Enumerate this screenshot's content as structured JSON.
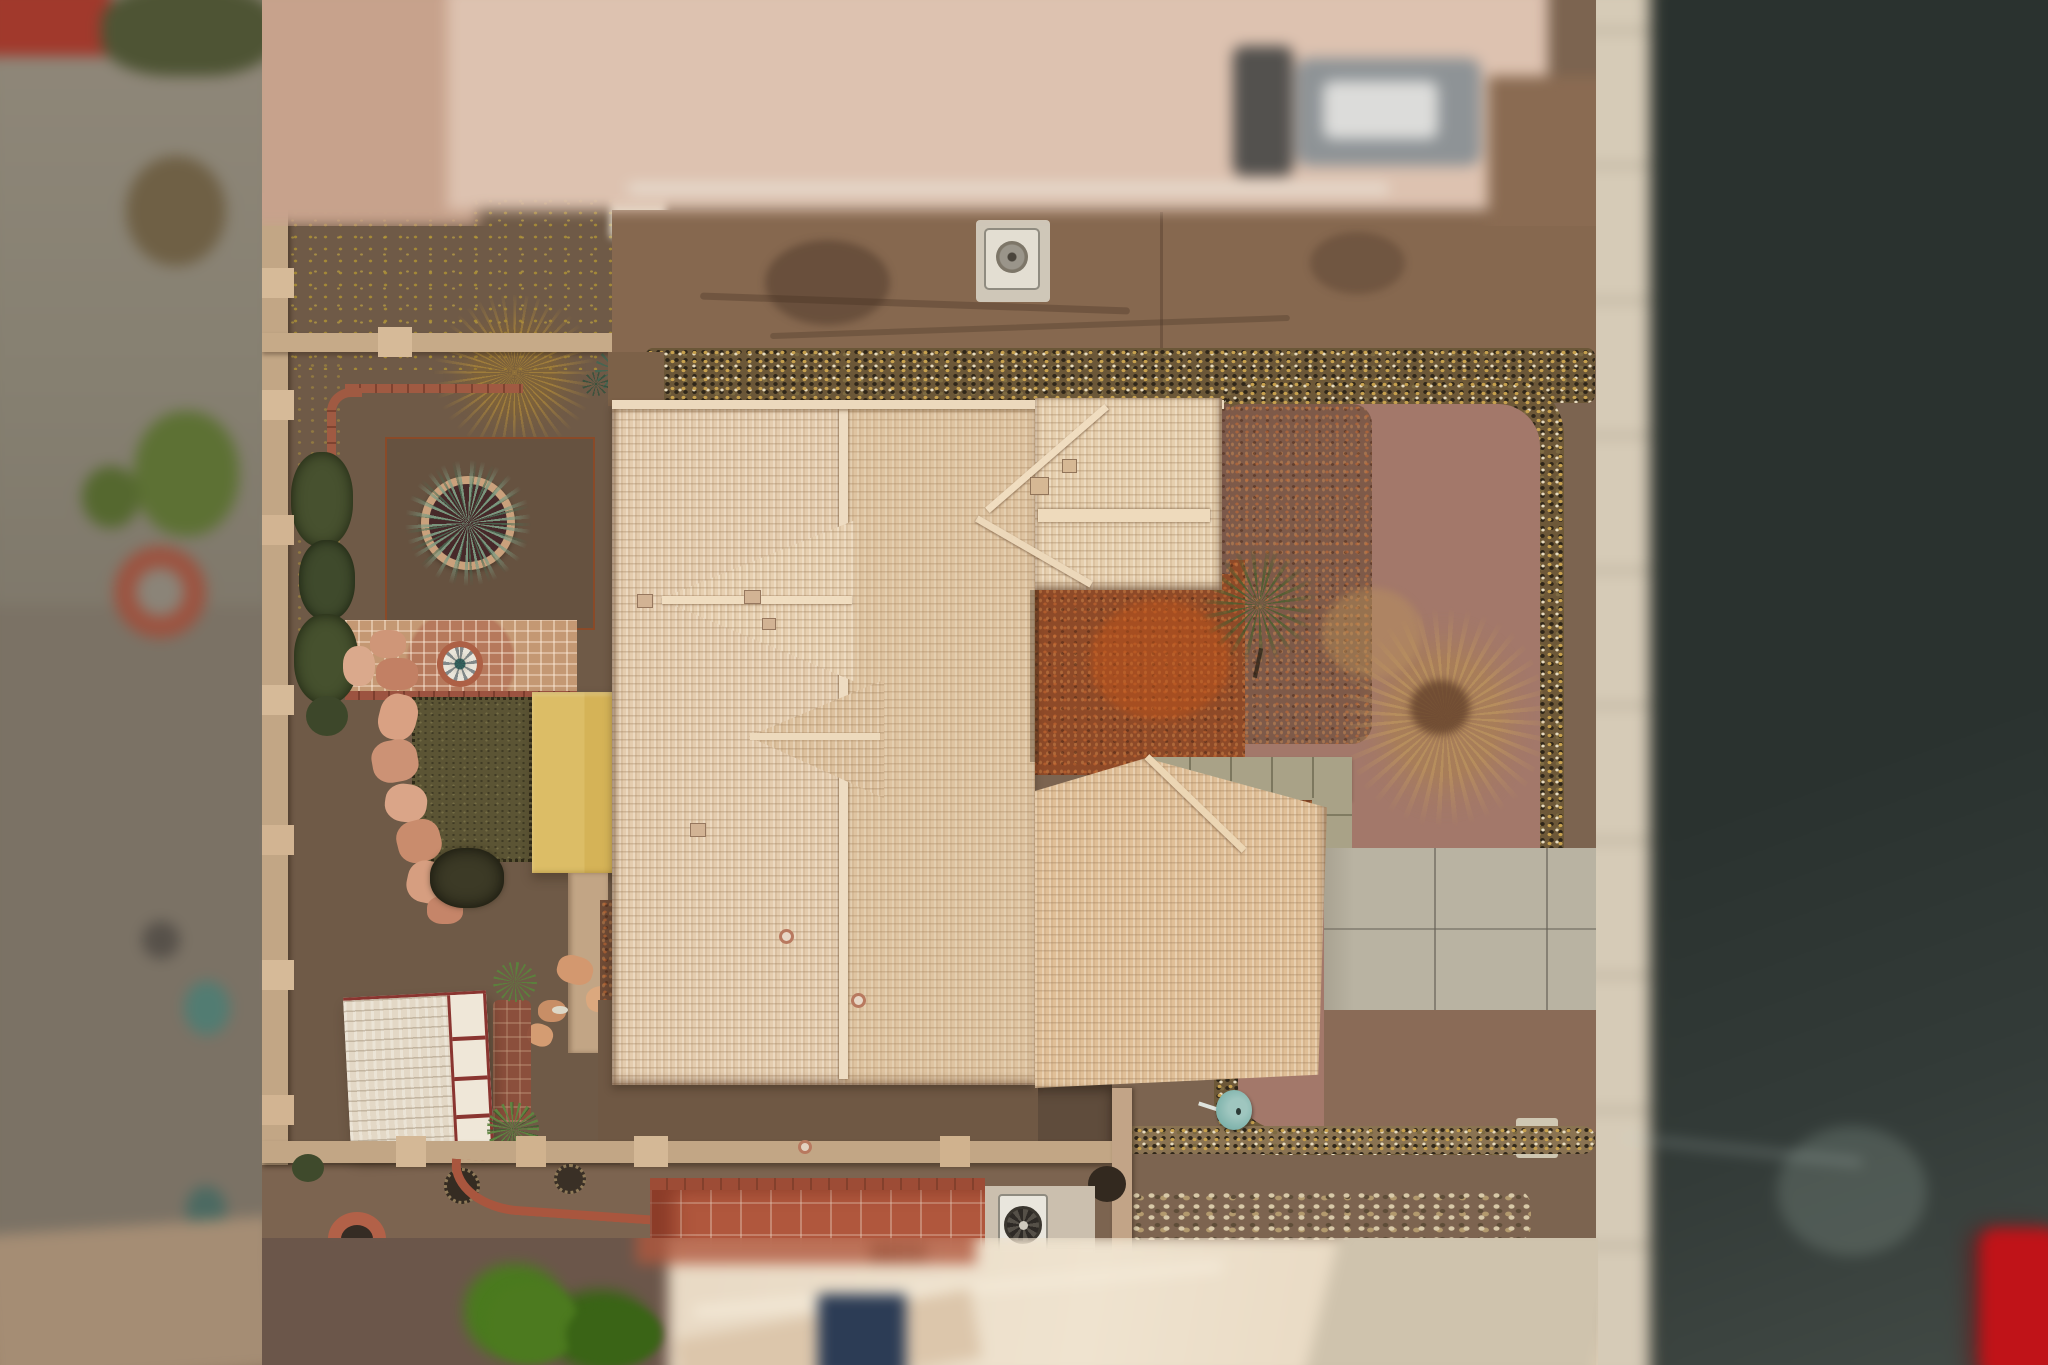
{
  "meta": {
    "title": "Aerial drone top-down view of a desert home with tan shingle roof",
    "image_type": "aerial-photograph",
    "visible_text": "none"
  },
  "scene": {
    "labels": {
      "main_roof": "main house tan shingle roof",
      "wing_roof_ne": "north-east hip roof wing",
      "wing_roof_se": "south-east hip roof wing",
      "gable_upper": "west-facing gable peak",
      "gable_lower": "lower west-facing gable peak",
      "backyard": "backyard dirt area",
      "fence_west": "tan block fence west side",
      "fence_north": "tan block fence north side",
      "fence_south": "tan block fence south side",
      "shed": "white shed roof with red trim",
      "yellow_canopy": "yellow shade canopy",
      "turf_square": "olive gravel bed",
      "planter": "round brick planter with agave",
      "garden_bed": "square garden bed with metal edging",
      "patio_fountain": "paver patio with white fountain",
      "flagstone_path": "salmon flagstone path",
      "dead_shrub": "dead leafless shrub",
      "front_yard_mulch": "front yard mulch with dead bush",
      "small_tree": "small green tree",
      "walkway": "tan paver walkway",
      "driveway_pad": "concrete parking pad",
      "gravel_band": "decorative rock gravel band",
      "sidewalk": "concrete sidewalk",
      "road": "asphalt street",
      "red_car": "red car parked on street (blurred)",
      "neighbor_left": "blurred neighboring property west",
      "neighbor_top": "blurred neighboring roof north",
      "front_house": "blurred front section roof south",
      "ac_unit_north": "ground utility unit north side",
      "ac_unit_south": "air-conditioning unit with fan",
      "satellite_dish": "teal satellite dish",
      "fire_pit": "round brick fire pit",
      "terracotta_patio": "terracotta tiled patio"
    },
    "palette": {
      "roof_tan": "#e4ccae",
      "roof_gold": "#e0bf97",
      "ridge_cap": "#eedabc",
      "backyard_dirt": "#6f5a47",
      "front_dirt": "#87684f",
      "gravel_dark": "#6b5738",
      "mulch_rust": "#8e4a28",
      "mulch_mauve": "#a3786a",
      "fence_tan": "#c2a685",
      "yellow_canopy": "#d9b85f",
      "shed_white": "#e6dccb",
      "shed_trim_red": "#8a3530",
      "patio_paver": "#c49873",
      "terracotta": "#b0573d",
      "walkway_tan": "#a9a287",
      "driveway_gray": "#b9b3a2",
      "sidewalk_cream": "#d6cbb7",
      "road_dark": "#2a322f",
      "car_red": "#c01318",
      "turf_olive": "#5b5434",
      "agave_green": "#5d7d62",
      "bush_green": "#4a7a1e",
      "dish_teal": "#7fb3ac"
    }
  }
}
